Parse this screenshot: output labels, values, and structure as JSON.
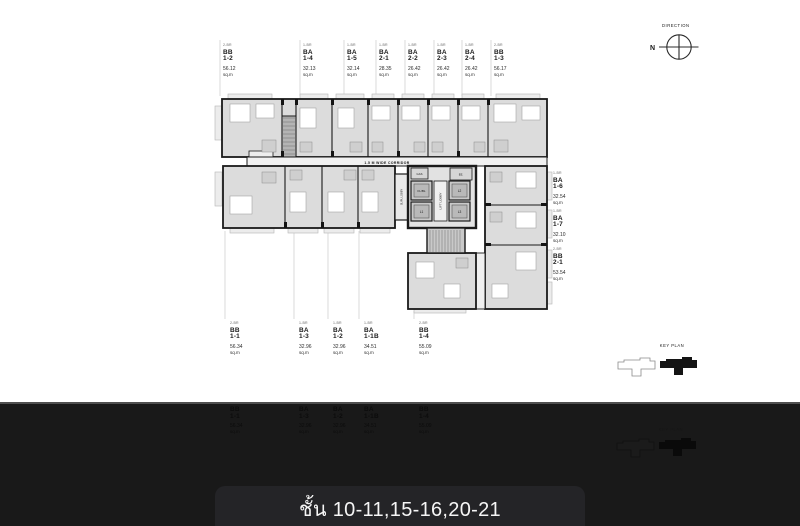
{
  "plan": {
    "corridor_label": "1.5 M WIDE CORRIDOR",
    "core": {
      "gas": "GAS",
      "ee": "EE.",
      "fl_bl": "FL/BL",
      "l1": "L1",
      "l2": "L2",
      "l3": "L3",
      "lift_lobby": "LIFT LOBBY",
      "sl_pl_lobby": "SL/PL LOBBY"
    }
  },
  "compass": {
    "title": "DIRECTION",
    "north": "N"
  },
  "key_plan": {
    "title": "KEY PLAN"
  },
  "labels": {
    "area_unit": "sq.m"
  },
  "units": {
    "top": [
      {
        "type": "2-BR",
        "code": "BB",
        "no": "1-2",
        "area": "56.12"
      },
      {
        "type": "1-BR",
        "code": "BA",
        "no": "1-4",
        "area": "32.13"
      },
      {
        "type": "1-BR",
        "code": "BA",
        "no": "1-5",
        "area": "32.14"
      },
      {
        "type": "1-BR",
        "code": "BA",
        "no": "2-1",
        "area": "28.35"
      },
      {
        "type": "1-BR",
        "code": "BA",
        "no": "2-2",
        "area": "26.42"
      },
      {
        "type": "1-BR",
        "code": "BA",
        "no": "2-3",
        "area": "26.42"
      },
      {
        "type": "1-BR",
        "code": "BA",
        "no": "2-4",
        "area": "26.42"
      },
      {
        "type": "2-BR",
        "code": "BB",
        "no": "1-3",
        "area": "56.17"
      }
    ],
    "right": [
      {
        "type": "1-BR",
        "code": "BA",
        "no": "1-6",
        "area": "32.54"
      },
      {
        "type": "1-BR",
        "code": "BA",
        "no": "1-7",
        "area": "32.10"
      },
      {
        "type": "2-BR",
        "code": "BB",
        "no": "2-1",
        "area": "53.54"
      }
    ],
    "bottom": [
      {
        "type": "2-BR",
        "code": "BB",
        "no": "1-1",
        "area": "56.34"
      },
      {
        "type": "1-BR",
        "code": "BA",
        "no": "1-3",
        "area": "32.96"
      },
      {
        "type": "1-BR",
        "code": "BA",
        "no": "1-2",
        "area": "32.96"
      },
      {
        "type": "1-BR",
        "code": "BA",
        "no": "1-1B",
        "area": "34.51"
      },
      {
        "type": "2-BR",
        "code": "BB",
        "no": "1-4",
        "area": "55.09"
      }
    ]
  },
  "floor_bar": {
    "text": "ชั้น 10-11,15-16,20-21"
  },
  "colors": {
    "page_bg": "#ffffff",
    "band_bg": "#191919",
    "bar_bg": "#242427",
    "plan_fill": "#dcdcdc",
    "wall": "#1a1a1a"
  }
}
